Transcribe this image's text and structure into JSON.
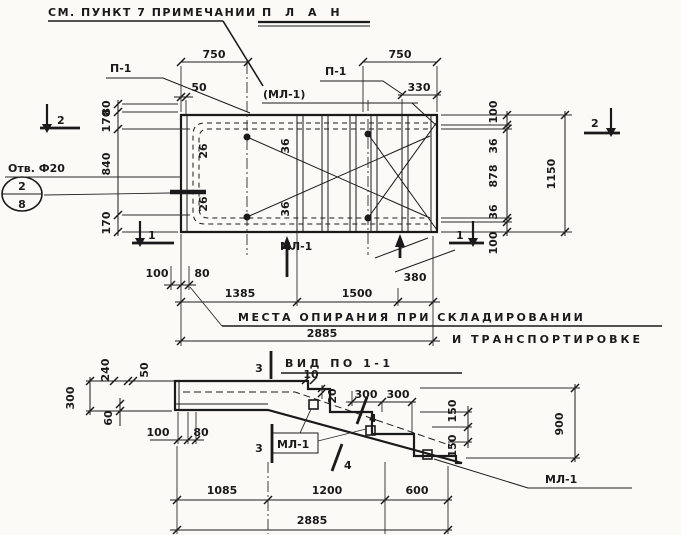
{
  "plan": {
    "note_text": "СМ. ПУНКТ 7 ПРИМЕЧАНИИ",
    "title": "П Л А Н",
    "ml1_callout": "(МЛ-1)",
    "p1_left": "П-1",
    "p1_right": "П-1",
    "ml1_bottom": "МЛ-1",
    "hole_label": "Отв. Ф20",
    "hole_circle_top": "2",
    "hole_circle_bottom": "8",
    "section_2_left": "2",
    "section_2_right": "2",
    "section_1_left": "1",
    "section_1_right": "1",
    "support_note_line1": "МЕСТА ОПИРАНИЯ ПРИ СКЛАДИРОВАНИИ",
    "support_note_line2": "И ТРАНСПОРТИРОВКЕ",
    "dims": {
      "top_750_left": "750",
      "top_750_right": "750",
      "top_330": "330",
      "top_50": "50",
      "left_80": "80",
      "left_170_top": "170",
      "left_840": "840",
      "left_170_bottom": "170",
      "right_100_top": "100",
      "right_36_top": "36",
      "right_878": "878",
      "right_36_bottom": "36",
      "right_100_bottom": "100",
      "right_overall_1150": "1150",
      "inner_26_top": "26",
      "inner_26_bottom": "26",
      "inner_36_top": "36",
      "inner_36_bottom": "36",
      "bottom_100": "100",
      "bottom_80": "80",
      "bottom_1385": "1385",
      "bottom_1500": "1500",
      "bottom_380": "380",
      "bottom_2885": "2885"
    }
  },
  "view": {
    "title": "ВИД ПО 1-1",
    "section_3_top": "3",
    "section_3_bottom": "3",
    "section_4_a": "4",
    "section_4_b": "4",
    "ml1_left": "МЛ-1",
    "ml1_right": "МЛ-1",
    "dims": {
      "left_300": "300",
      "top_240": "240",
      "top_50": "50",
      "left_60": "60",
      "left_100": "100",
      "left_80": "80",
      "nose_10": "10",
      "nose_20": "20",
      "tread_300_a": "300",
      "tread_300_b": "300",
      "rise_150_a": "150",
      "rise_150_b": "150",
      "right_900": "900",
      "bottom_1085": "1085",
      "bottom_1200": "1200",
      "bottom_600": "600",
      "bottom_2885": "2885"
    }
  }
}
